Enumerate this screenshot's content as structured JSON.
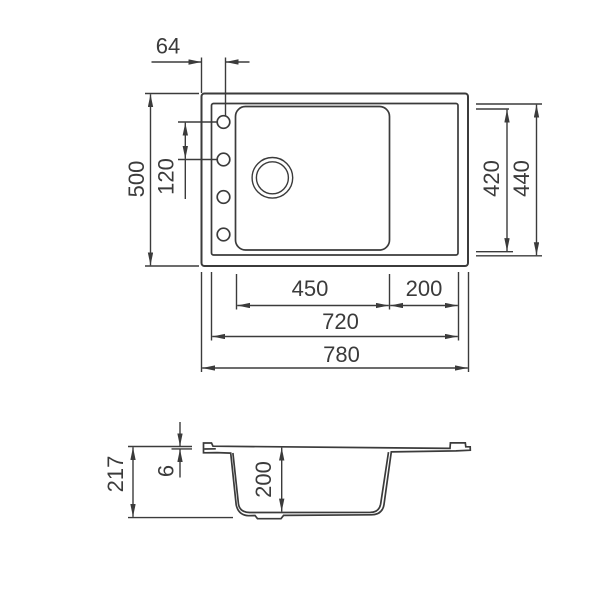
{
  "drawing": {
    "background": "#ffffff",
    "line_color": "#3b3b3b",
    "top_view": {
      "dims": {
        "hole_offset": "64",
        "overall_depth": "500",
        "hole_spacing": "120",
        "bowl_inner_depth": "420",
        "rim_depth": "440",
        "bowl_width": "450",
        "drainboard_width": "200",
        "rim_width": "720",
        "overall_width": "780"
      }
    },
    "side_view": {
      "dims": {
        "total_height": "217",
        "rim_thickness": "6",
        "bowl_depth": "200"
      }
    }
  }
}
